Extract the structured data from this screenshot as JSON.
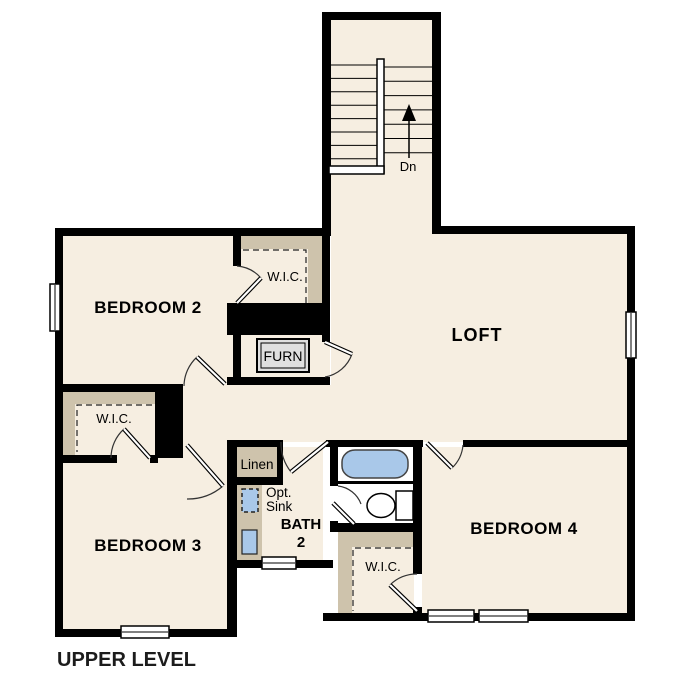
{
  "plan": {
    "title": "UPPER LEVEL",
    "rooms": {
      "bedroom2": "BEDROOM 2",
      "bedroom3": "BEDROOM 3",
      "bedroom4": "BEDROOM 4",
      "loft": "LOFT",
      "bath": {
        "line1": "BATH",
        "line2": "2"
      }
    },
    "labels": {
      "wic": "W.I.C.",
      "linen": "Linen",
      "furnace": "FURN",
      "opt_sink_line1": "Opt.",
      "opt_sink_line2": "Sink",
      "stairs_down": "Dn"
    },
    "colors": {
      "background": "#ffffff",
      "floor": "#f6eee1",
      "shelving": "#cec3ac",
      "wall": "#000000",
      "fixture_blue": "#a9c8e9",
      "furnace_gray": "#e0e0e0"
    }
  }
}
